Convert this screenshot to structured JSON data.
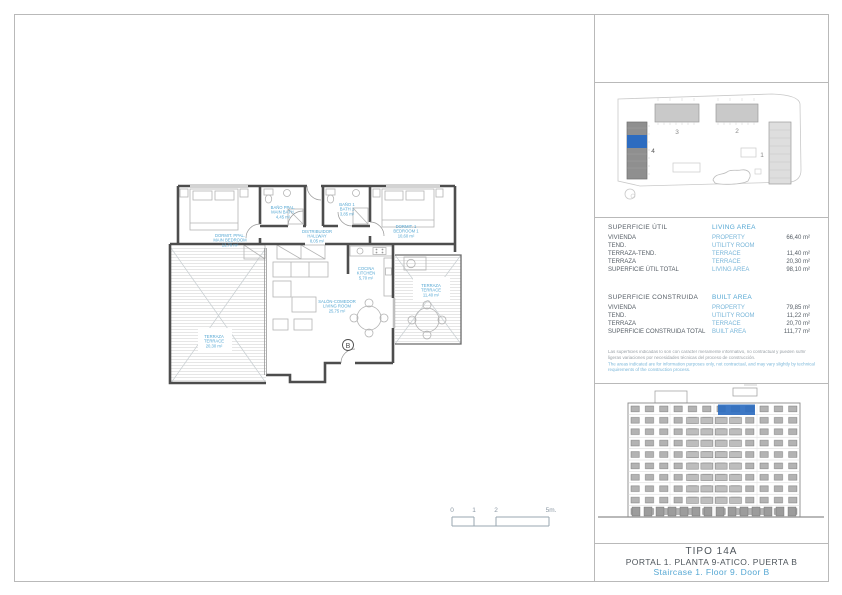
{
  "sheet": {
    "title": "TIPO 14A",
    "subtitle_es": "PORTAL 1. PLANTA 9-ATICO. PUERTA B",
    "subtitle_en": "Staircase 1. Floor 9. Door B"
  },
  "area_tables": {
    "useful": {
      "header_es": "SUPERFICIE ÚTIL",
      "header_en": "LIVING AREA",
      "rows": [
        {
          "es": "VIVIENDA",
          "en": "PROPERTY",
          "value": "66,40 m²"
        },
        {
          "es": "TEND.",
          "en": "UTILITY ROOM",
          "value": ""
        },
        {
          "es": "TERRAZA-TEND.",
          "en": "TERRACE",
          "value": "11,40 m²"
        },
        {
          "es": "TERRAZA",
          "en": "TERRACE",
          "value": "20,30 m²"
        },
        {
          "es": "SUPERFICIE ÚTIL TOTAL",
          "en": "LIVING AREA",
          "value": "98,10 m²"
        }
      ]
    },
    "built": {
      "header_es": "SUPERFICIE CONSTRUIDA",
      "header_en": "BUILT AREA",
      "rows": [
        {
          "es": "VIVIENDA",
          "en": "PROPERTY",
          "value": "79,85 m²"
        },
        {
          "es": "TEND.",
          "en": "UTILITY ROOM",
          "value": "11,22 m²"
        },
        {
          "es": "TERRAZA",
          "en": "TERRACE",
          "value": "20,70 m²"
        },
        {
          "es": "SUPERFICIE CONSTRUIDA TOTAL",
          "en": "BUILT AREA",
          "value": "111,77 m²"
        }
      ]
    },
    "disclaimer_es": "Las superficies indicadas lo son con carácter meramente informativo, no contractual y pueden sufrir ligeras variaciones por necesidades técnicas del proceso de construcción.",
    "disclaimer_en": "The areas indicated are for information purposes only, not contractual, and may vary slightly by technical requirements of the construction process."
  },
  "floor_plan": {
    "door_marker": "B",
    "rooms": [
      {
        "es": "DORMIT. PPAL.",
        "en": "MAIN BEDROOM",
        "area": "13,70 m²"
      },
      {
        "es": "BAÑO PPAL.",
        "en": "MAIN BATH.",
        "area": "4,45 m²"
      },
      {
        "es": "DISTRIBUIDOR",
        "en": "HALLWAY",
        "area": "8,05 m²"
      },
      {
        "es": "BAÑO 1",
        "en": "BATH 1",
        "area": "3,85 m²"
      },
      {
        "es": "DORMIT. 1",
        "en": "BEDROOM 1",
        "area": "10,60 m²"
      },
      {
        "es": "SALÓN-COMEDOR",
        "en": "LIVING ROOM",
        "area": "25,75 m²"
      },
      {
        "es": "COCINA",
        "en": "KITCHEN",
        "area": "5,70 m²"
      },
      {
        "es": "TERRAZA",
        "en": "TERRACE",
        "area": "20,30 m²"
      },
      {
        "es": "TERRAZA",
        "en": "TERRACE",
        "area": "11,40 m²"
      }
    ]
  },
  "scale_bar": {
    "labels": [
      "0",
      "1",
      "2",
      "5m."
    ]
  },
  "site_plan": {
    "building_labels": [
      "1",
      "2",
      "3",
      "4"
    ]
  },
  "colors": {
    "accent_blue": "#55a7d3",
    "highlight_blue": "#2d6cc0",
    "text_dark": "#565e66",
    "line_gray": "#b9b9b9"
  }
}
